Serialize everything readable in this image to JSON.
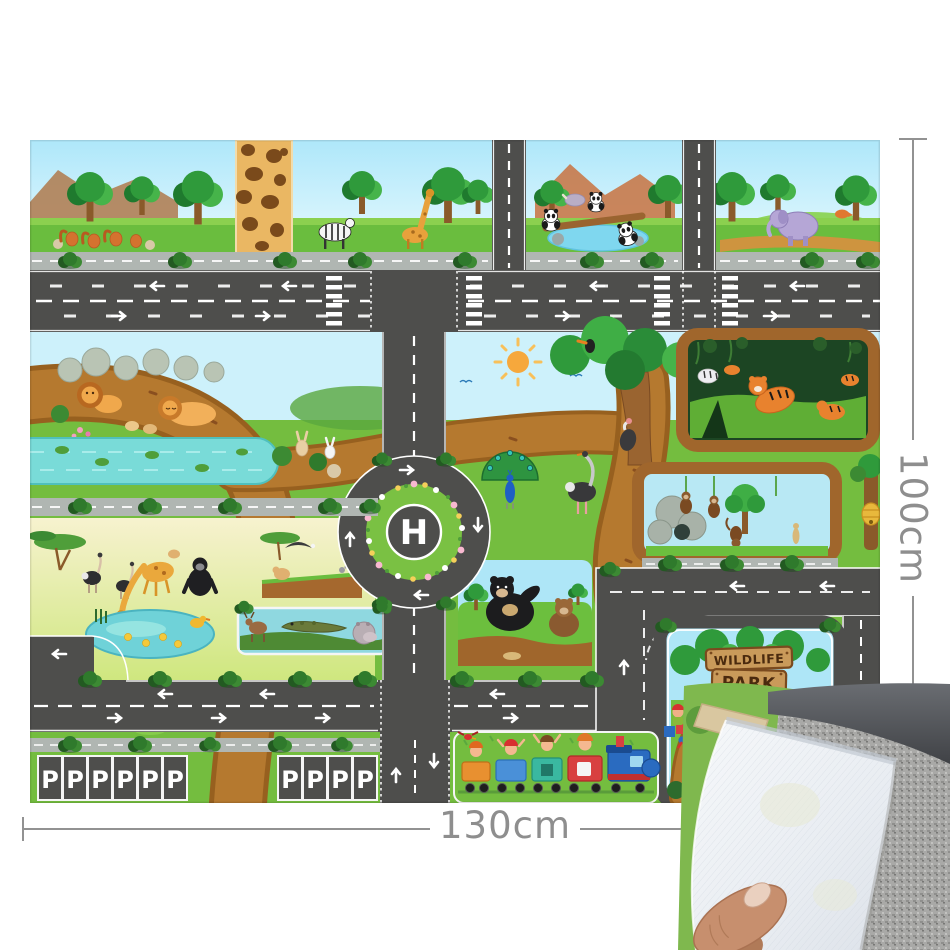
{
  "photo": {
    "background_color": "#ffffff",
    "dimensions": {
      "width_label": "130cm",
      "height_label": "100cm",
      "annotation_color": "#8e8e8e"
    },
    "mat": {
      "helipad_label": "H",
      "parking": {
        "stall_label": "P",
        "left_group_count": 6,
        "right_group_count": 4
      },
      "sign": {
        "line1": "WILDLIFE",
        "line2": "PARK"
      },
      "palette": {
        "road": "#4e4e4c",
        "road_marking": "#ffffff",
        "grass": "#74bd3f",
        "sky": "#bfeffc",
        "dirt_path": "#b5792f",
        "water": "#79dbd8",
        "sidewalk": "#b0b6b2",
        "sign_wood": "#c99a5a"
      }
    },
    "peel": {
      "underside_color": "#eef1f5",
      "carpet_color": "#a6a6a4"
    }
  }
}
